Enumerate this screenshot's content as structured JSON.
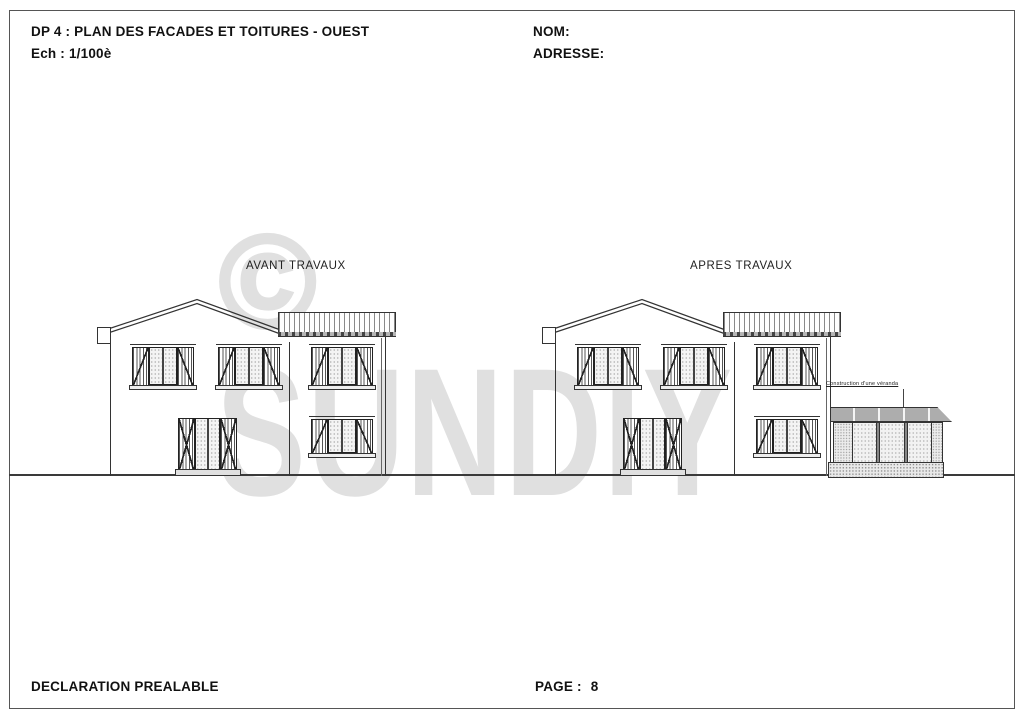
{
  "page": {
    "title": "DP 4 : PLAN DES FACADES ET TOITURES - OUEST",
    "scale": "Ech : 1/100è",
    "name_label": "NOM:",
    "address_label": "ADRESSE:",
    "footer_doc_type": "DECLARATION PREALABLE",
    "footer_page_label": "PAGE :",
    "footer_page_number": "8"
  },
  "elevations": {
    "before": {
      "label": "AVANT TRAVAUX"
    },
    "after": {
      "label": "APRES TRAVAUX",
      "annotation": "Construction d'une véranda"
    }
  },
  "watermark": {
    "symbol": "©",
    "text": "SUNDIY",
    "color": "#e0e0e0"
  },
  "colors": {
    "line": "#333333",
    "frame": "#555555",
    "ground": "#3a3a3a"
  }
}
